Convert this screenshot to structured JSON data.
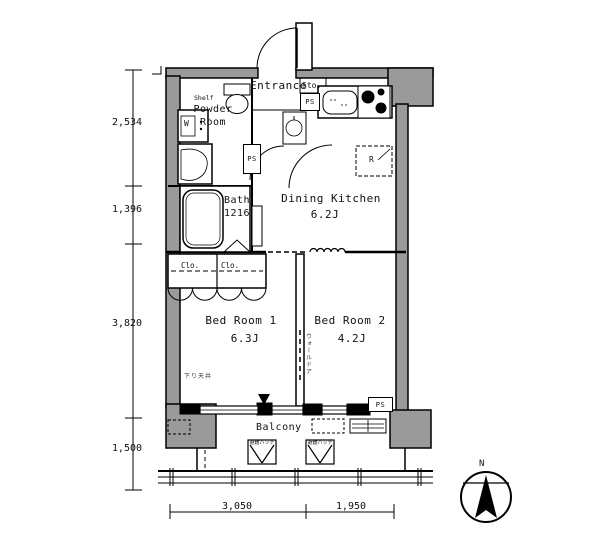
{
  "rooms": {
    "entrance": {
      "label": "Entrance"
    },
    "storage": {
      "label": "Sto."
    },
    "powder_room": {
      "label": "Powder\nRoom",
      "shelf": "Shelf",
      "washer": "W"
    },
    "bath": {
      "label": "Bath",
      "size": "1216"
    },
    "dining_kitchen": {
      "label": "Dining Kitchen",
      "size": "6.2J",
      "fridge": "R"
    },
    "bedroom1": {
      "label": "Bed Room 1",
      "size": "6.3J",
      "ceiling_note": "下り天井"
    },
    "bedroom2": {
      "label": "Bed Room 2",
      "size": "4.2J",
      "partition_note": "ウォールドア"
    },
    "balcony": {
      "label": "Balcony",
      "hatch": "避難ハッチ"
    }
  },
  "closets": {
    "closet1": "Clo.",
    "closet2": "Clo."
  },
  "shafts": {
    "ps_top": "PS",
    "ps_mid": "PS",
    "ps_bottom": "PS"
  },
  "compass": {
    "north": "N"
  },
  "dimensions": {
    "left": [
      "2,534",
      "1,396",
      "3,820",
      "1,500"
    ],
    "bottom": [
      "3,050",
      "1,950"
    ]
  },
  "colors": {
    "wall_fill": "#9a9a9a",
    "line": "#000000",
    "background": "#ffffff"
  }
}
